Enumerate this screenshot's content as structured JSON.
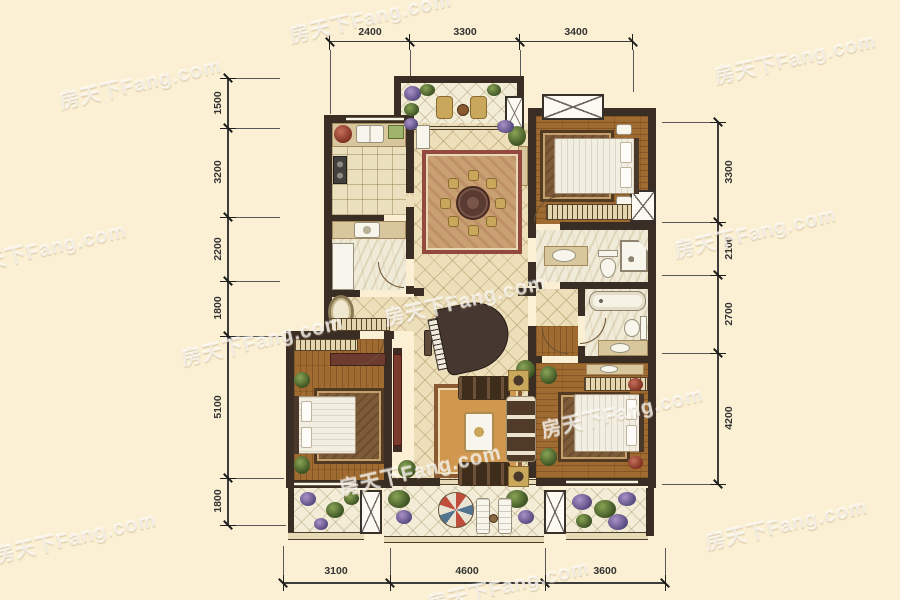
{
  "watermark": {
    "text": "房天下Fang.com"
  },
  "dimensions": {
    "top": [
      "2400",
      "3300",
      "3400"
    ],
    "left": [
      "1500",
      "3200",
      "2200",
      "1800",
      "5100",
      "1800"
    ],
    "right": [
      "3300",
      "2100",
      "2700",
      "4200"
    ],
    "bottom": [
      "3100",
      "4600",
      "3600"
    ]
  },
  "palette": {
    "background": "#fbf0d3",
    "wall": "#3a2e24",
    "wood_floor": "#a06b31",
    "tile_floor": "#ecdfba",
    "marble_floor": "#f0ead8",
    "dining_rug_border": "#94493e",
    "living_rug": "#d0984f",
    "dimension_text": "#333333",
    "watermark_color": "rgba(255,255,255,0.62)"
  }
}
